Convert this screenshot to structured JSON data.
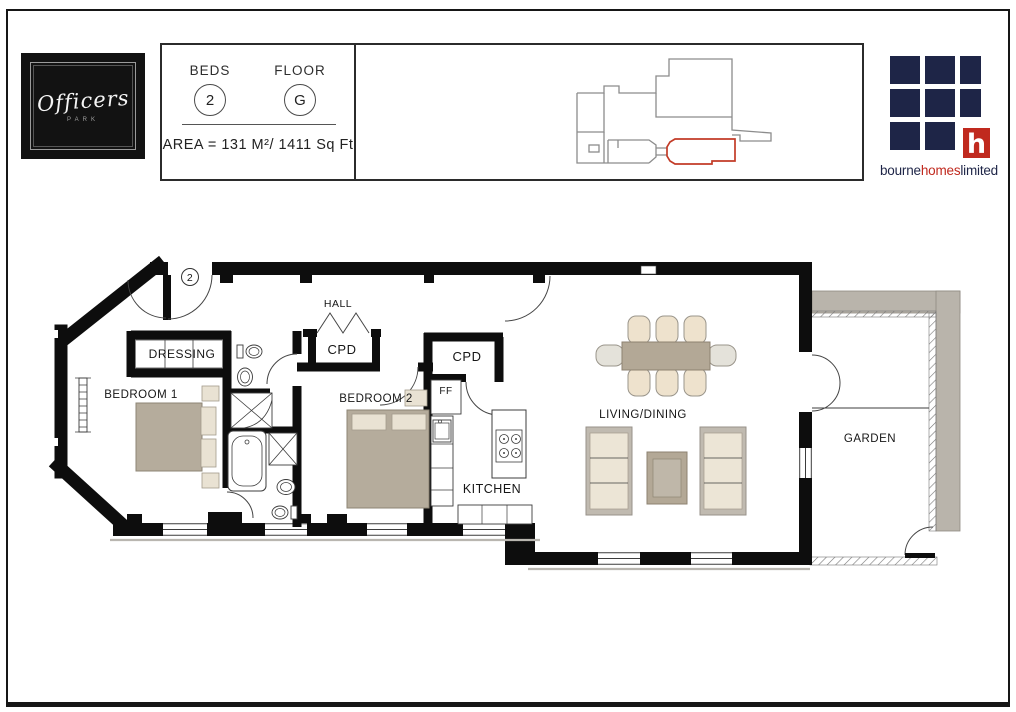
{
  "header": {
    "beds_label": "BEDS",
    "beds_value": "2",
    "floor_label": "FLOOR",
    "floor_value": "G",
    "area_text": "AREA = 131 M²/ 1411 Sq Ft"
  },
  "logos": {
    "officers": {
      "name": "Officers",
      "subtitle": "PARK"
    },
    "bourne": {
      "part1": "bourne",
      "part2": "homes",
      "part3": "limited",
      "mark_letter": "h"
    }
  },
  "plan": {
    "entrance_number": "2",
    "rooms": {
      "hall": "HALL",
      "cpd1": "CPD",
      "cpd2": "CPD",
      "dressing": "DRESSING",
      "bedroom1": "BEDROOM 1",
      "bedroom2": "BEDROOM 2",
      "ff": "FF",
      "kitchen": "KITCHEN",
      "living_dining": "LIVING/DINING",
      "garden": "GARDEN"
    }
  },
  "colors": {
    "navy": "#1e2547",
    "brand_red": "#c0291e",
    "plan_red": "#c23b27",
    "wall": "#0d0d0d"
  }
}
